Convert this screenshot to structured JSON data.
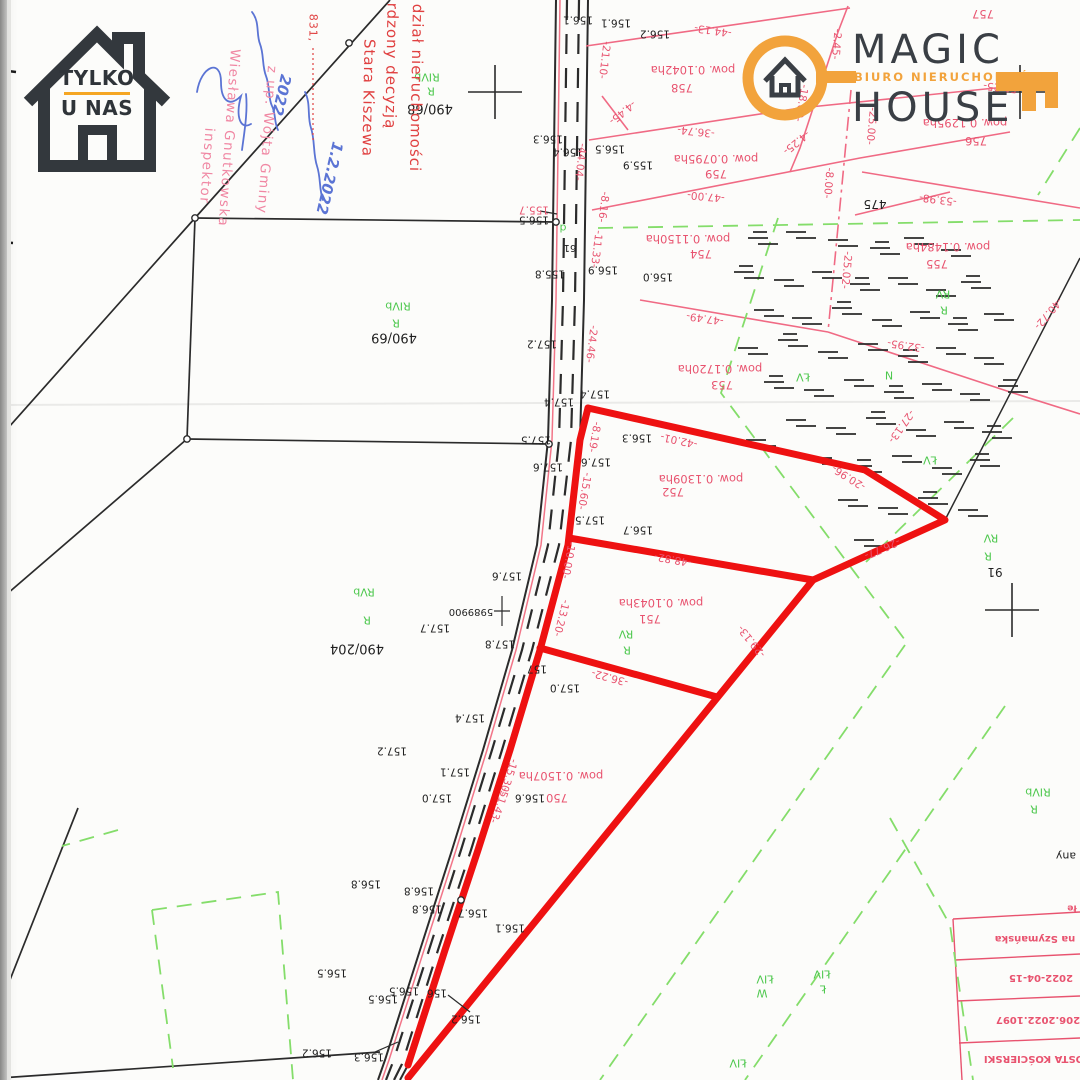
{
  "branding": {
    "tylko_u_nas": {
      "line1": "TYLKO",
      "line2": "U NAS",
      "accent_color": "#F5A623"
    },
    "magic_house": {
      "word1": "MAGIC",
      "word2": "HOUSE",
      "subtitle": "BIURO NIERUCHOMOŚCI",
      "accent_color": "#F2A33C",
      "text_color": "#3A3F45"
    }
  },
  "stamps": {
    "office": {
      "color": "#E04040",
      "lines": [
        {
          "t": "dział nieruchomości",
          "x": 416,
          "y": 88,
          "r": 91
        },
        {
          "t": "rdzony decyzją",
          "x": 391,
          "y": 66,
          "r": 91
        },
        {
          "t": "Stara Kiszewa",
          "x": 368,
          "y": 98,
          "r": 91
        },
        {
          "t": "831,",
          "x": 313,
          "y": 28,
          "r": 91,
          "s": 11
        }
      ]
    },
    "wojt": {
      "color": "#F087A3",
      "lines": [
        {
          "t": "z up. Wójta Gminy",
          "x": 266,
          "y": 140,
          "r": 94
        },
        {
          "t": "Wiesława Gnutkowska",
          "x": 228,
          "y": 138,
          "r": 94
        },
        {
          "t": "inspektor",
          "x": 206,
          "y": 166,
          "r": 94
        }
      ]
    },
    "handwriting": {
      "color": "#5B74D4",
      "lines": [
        {
          "t": "2022",
          "x": 281,
          "y": 95,
          "r": 103
        },
        {
          "t": "1.2.2022",
          "x": 329,
          "y": 178,
          "r": 103
        }
      ]
    }
  },
  "registry_table": {
    "color": "#E8536F",
    "rows": [
      {
        "t": "na Szymańska",
        "x": 1035,
        "y": 938
      },
      {
        "t": "2022-04-15",
        "x": 1041,
        "y": 977
      },
      {
        "t": "206.2022.1097",
        "x": 1038,
        "y": 1019
      },
      {
        "t": "OSTA KOŚCIERSKI",
        "x": 1034,
        "y": 1058
      }
    ],
    "notes": [
      {
        "t": "any",
        "x": 1066,
        "y": 856,
        "c": "b",
        "s": 11
      },
      {
        "t": "łe",
        "x": 1072,
        "y": 907,
        "c": "t",
        "s": 9
      }
    ]
  },
  "map": {
    "highlight_color": "#EE1111",
    "parcel_line_color": "#F06A84",
    "soil_line_color": "#84DD6A",
    "boundary_color": "#2B2B2B",
    "highlighted_parcel_numbers": [
      "750",
      "751",
      "752"
    ],
    "labels": [
      {
        "t": "156.1",
        "x": 578,
        "y": 19,
        "c": "b"
      },
      {
        "t": "156.1",
        "x": 616,
        "y": 22,
        "c": "b"
      },
      {
        "t": "156.2",
        "x": 655,
        "y": 33,
        "c": "b"
      },
      {
        "t": "156.3",
        "x": 548,
        "y": 138,
        "c": "b"
      },
      {
        "t": "156.4",
        "x": 568,
        "y": 151,
        "c": "b"
      },
      {
        "t": "156.5",
        "x": 610,
        "y": 148,
        "c": "b"
      },
      {
        "t": "155.9",
        "x": 638,
        "y": 164,
        "c": "b"
      },
      {
        "t": "156.5",
        "x": 534,
        "y": 219,
        "c": "b"
      },
      {
        "t": "155.7",
        "x": 534,
        "y": 209,
        "c": "m"
      },
      {
        "t": "155.8",
        "x": 550,
        "y": 273,
        "c": "b"
      },
      {
        "t": "156.9",
        "x": 603,
        "y": 269,
        "c": "b"
      },
      {
        "t": "156.0",
        "x": 658,
        "y": 276,
        "c": "b"
      },
      {
        "t": "157.2",
        "x": 542,
        "y": 343,
        "c": "b"
      },
      {
        "t": "157.4",
        "x": 595,
        "y": 393,
        "c": "b"
      },
      {
        "t": "157.4",
        "x": 559,
        "y": 401,
        "c": "b"
      },
      {
        "t": "157.5",
        "x": 536,
        "y": 439,
        "c": "b"
      },
      {
        "t": "157.6",
        "x": 548,
        "y": 466,
        "c": "b"
      },
      {
        "t": "157.6",
        "x": 596,
        "y": 461,
        "c": "b"
      },
      {
        "t": "157.5",
        "x": 590,
        "y": 519,
        "c": "b"
      },
      {
        "t": "156.7",
        "x": 638,
        "y": 529,
        "c": "b"
      },
      {
        "t": "156.3",
        "x": 637,
        "y": 437,
        "c": "b"
      },
      {
        "t": "157.6",
        "x": 507,
        "y": 575,
        "c": "b"
      },
      {
        "t": "157.7",
        "x": 435,
        "y": 627,
        "c": "b"
      },
      {
        "t": "157.8",
        "x": 500,
        "y": 643,
        "c": "b"
      },
      {
        "t": "157",
        "x": 537,
        "y": 668,
        "c": "b"
      },
      {
        "t": "157.0",
        "x": 565,
        "y": 687,
        "c": "b"
      },
      {
        "t": "157.4",
        "x": 470,
        "y": 717,
        "c": "b"
      },
      {
        "t": "157.2",
        "x": 392,
        "y": 750,
        "c": "b"
      },
      {
        "t": "157.1",
        "x": 455,
        "y": 771,
        "c": "b"
      },
      {
        "t": "157.0",
        "x": 437,
        "y": 797,
        "c": "b"
      },
      {
        "t": "156.6",
        "x": 530,
        "y": 797,
        "c": "b"
      },
      {
        "t": "156.8",
        "x": 366,
        "y": 883,
        "c": "b"
      },
      {
        "t": "156.8",
        "x": 419,
        "y": 890,
        "c": "b"
      },
      {
        "t": "156.8",
        "x": 427,
        "y": 908,
        "c": "b"
      },
      {
        "t": "156.7",
        "x": 473,
        "y": 912,
        "c": "b"
      },
      {
        "t": "156.1",
        "x": 510,
        "y": 927,
        "c": "b"
      },
      {
        "t": "156.5",
        "x": 332,
        "y": 972,
        "c": "b"
      },
      {
        "t": "156.5",
        "x": 404,
        "y": 990,
        "c": "b"
      },
      {
        "t": "156.5",
        "x": 383,
        "y": 998,
        "c": "b"
      },
      {
        "t": "156",
        "x": 437,
        "y": 992,
        "c": "b"
      },
      {
        "t": "156.2",
        "x": 466,
        "y": 1018,
        "c": "b"
      },
      {
        "t": "156.2",
        "x": 317,
        "y": 1052,
        "c": "b"
      },
      {
        "t": "156.3",
        "x": 369,
        "y": 1056,
        "c": "b"
      },
      {
        "t": "490/68",
        "x": 430,
        "y": 108,
        "c": "b",
        "s": 13
      },
      {
        "t": "490/69",
        "x": 394,
        "y": 337,
        "c": "b",
        "s": 13
      },
      {
        "t": "490/204",
        "x": 357,
        "y": 648,
        "c": "b",
        "s": 13
      },
      {
        "t": "91",
        "x": 995,
        "y": 572,
        "c": "b",
        "s": 12
      },
      {
        "t": "475",
        "x": 875,
        "y": 204,
        "c": "b",
        "s": 12
      },
      {
        "t": "5989900",
        "x": 471,
        "y": 611,
        "c": "b",
        "s": 10
      },
      {
        "t": "61",
        "x": 570,
        "y": 247,
        "c": "b",
        "s": 10
      },
      {
        "t": "-44.13-",
        "x": 713,
        "y": 30,
        "r": 188,
        "c": "m"
      },
      {
        "t": "-21.10-",
        "x": 604,
        "y": 60,
        "r": 97,
        "c": "m"
      },
      {
        "t": "-4.45-",
        "x": 622,
        "y": 112,
        "r": 140,
        "c": "m"
      },
      {
        "t": "-36.74-",
        "x": 696,
        "y": 131,
        "r": 186,
        "c": "m"
      },
      {
        "t": "-47.00-",
        "x": 706,
        "y": 196,
        "r": 185,
        "c": "m"
      },
      {
        "t": "-8.16-",
        "x": 603,
        "y": 207,
        "r": 97,
        "c": "m"
      },
      {
        "t": "-11.33-",
        "x": 596,
        "y": 249,
        "r": 97,
        "c": "m"
      },
      {
        "t": "-44.04-",
        "x": 580,
        "y": 162,
        "r": 97,
        "c": "m"
      },
      {
        "t": "-24.46-",
        "x": 591,
        "y": 344,
        "r": 97,
        "c": "m"
      },
      {
        "t": "-8.19-",
        "x": 594,
        "y": 437,
        "r": 100,
        "c": "m"
      },
      {
        "t": "-15.60-",
        "x": 584,
        "y": 491,
        "r": 100,
        "c": "m"
      },
      {
        "t": "-42.01-",
        "x": 679,
        "y": 440,
        "r": 192,
        "c": "m"
      },
      {
        "t": "-20.96-",
        "x": 849,
        "y": 477,
        "r": 212,
        "c": "m"
      },
      {
        "t": "-26.77-",
        "x": 882,
        "y": 548,
        "r": 156,
        "c": "m"
      },
      {
        "t": "-48.82-",
        "x": 673,
        "y": 559,
        "r": 190,
        "c": "m"
      },
      {
        "t": "-10.00-",
        "x": 568,
        "y": 560,
        "r": 100,
        "c": "m"
      },
      {
        "t": "-29.13-",
        "x": 752,
        "y": 641,
        "r": 231,
        "c": "m"
      },
      {
        "t": "-13.20-",
        "x": 561,
        "y": 618,
        "r": 104,
        "c": "m"
      },
      {
        "t": "-36.22-",
        "x": 610,
        "y": 677,
        "r": 195,
        "c": "m"
      },
      {
        "t": "-15.30-",
        "x": 508,
        "y": 777,
        "r": 108,
        "c": "m"
      },
      {
        "t": "-51.43-",
        "x": 499,
        "y": 805,
        "r": 110,
        "c": "m"
      },
      {
        "t": "-47.49-",
        "x": 705,
        "y": 318,
        "r": 188,
        "c": "m"
      },
      {
        "t": "-25.02-",
        "x": 846,
        "y": 270,
        "r": 95,
        "c": "m"
      },
      {
        "t": "-32.95-",
        "x": 906,
        "y": 345,
        "r": 188,
        "c": "m"
      },
      {
        "t": "-53.98-",
        "x": 938,
        "y": 199,
        "r": 187,
        "c": "m"
      },
      {
        "t": "-40.72-",
        "x": 1048,
        "y": 313,
        "r": 130,
        "c": "m"
      },
      {
        "t": "-27.13-",
        "x": 901,
        "y": 426,
        "r": 125,
        "c": "m"
      },
      {
        "t": "-2.45-",
        "x": 836,
        "y": 44,
        "r": 95,
        "c": "m"
      },
      {
        "t": "-18.69-",
        "x": 801,
        "y": 103,
        "r": 100,
        "c": "m"
      },
      {
        "t": "-4.25-",
        "x": 796,
        "y": 142,
        "r": 140,
        "c": "m"
      },
      {
        "t": "-25.00-",
        "x": 871,
        "y": 126,
        "r": 95,
        "c": "m"
      },
      {
        "t": "-51.25-",
        "x": 1002,
        "y": 87,
        "r": 186,
        "c": "m"
      },
      {
        "t": "-8.00-",
        "x": 828,
        "y": 183,
        "r": 95,
        "c": "m"
      },
      {
        "t": "pow. 0.1042ha",
        "x": 693,
        "y": 69,
        "c": "p"
      },
      {
        "t": "758",
        "x": 682,
        "y": 87,
        "c": "p"
      },
      {
        "t": "pow. 0.0795ha",
        "x": 716,
        "y": 158,
        "c": "p"
      },
      {
        "t": "759",
        "x": 716,
        "y": 173,
        "c": "p"
      },
      {
        "t": "pow. 0.1150ha",
        "x": 688,
        "y": 238,
        "c": "p"
      },
      {
        "t": "754",
        "x": 701,
        "y": 253,
        "c": "p"
      },
      {
        "t": "pow. 0.1720ha",
        "x": 720,
        "y": 368,
        "c": "p"
      },
      {
        "t": "753",
        "x": 722,
        "y": 384,
        "c": "p"
      },
      {
        "t": "pow. 0.1484ha",
        "x": 948,
        "y": 246,
        "c": "p"
      },
      {
        "t": "755",
        "x": 937,
        "y": 263,
        "c": "p"
      },
      {
        "t": "pow. 0.1295ha",
        "x": 965,
        "y": 122,
        "c": "p"
      },
      {
        "t": "756",
        "x": 976,
        "y": 140,
        "c": "p"
      },
      {
        "t": "757",
        "x": 983,
        "y": 13,
        "c": "p"
      },
      {
        "t": "pow. 0.1309ha",
        "x": 701,
        "y": 478,
        "c": "p"
      },
      {
        "t": "752",
        "x": 673,
        "y": 491,
        "c": "p"
      },
      {
        "t": "pow. 0.1043ha",
        "x": 661,
        "y": 602,
        "c": "p"
      },
      {
        "t": "751",
        "x": 650,
        "y": 618,
        "c": "p"
      },
      {
        "t": "pow. 0.1507ha",
        "x": 561,
        "y": 775,
        "c": "p"
      },
      {
        "t": "750",
        "x": 557,
        "y": 797,
        "c": "p"
      },
      {
        "t": "RIVb",
        "x": 427,
        "y": 77,
        "c": "g"
      },
      {
        "t": "R",
        "x": 431,
        "y": 91,
        "c": "g"
      },
      {
        "t": "RIVb",
        "x": 398,
        "y": 306,
        "c": "g"
      },
      {
        "t": "R",
        "x": 396,
        "y": 323,
        "c": "g"
      },
      {
        "t": "RVb",
        "x": 364,
        "y": 592,
        "c": "g"
      },
      {
        "t": "R",
        "x": 367,
        "y": 620,
        "c": "g"
      },
      {
        "t": "RV",
        "x": 626,
        "y": 634,
        "c": "g"
      },
      {
        "t": "R",
        "x": 627,
        "y": 650,
        "c": "g"
      },
      {
        "t": "RV",
        "x": 943,
        "y": 294,
        "c": "g"
      },
      {
        "t": "R",
        "x": 944,
        "y": 310,
        "c": "g"
      },
      {
        "t": "RV",
        "x": 991,
        "y": 538,
        "c": "g"
      },
      {
        "t": "R",
        "x": 988,
        "y": 556,
        "c": "g"
      },
      {
        "t": "ŁV",
        "x": 803,
        "y": 377,
        "c": "g"
      },
      {
        "t": "ŁV",
        "x": 930,
        "y": 460,
        "c": "g"
      },
      {
        "t": "N",
        "x": 889,
        "y": 375,
        "c": "g"
      },
      {
        "t": "ŁIV",
        "x": 765,
        "y": 979,
        "c": "g"
      },
      {
        "t": "W",
        "x": 762,
        "y": 993,
        "c": "g"
      },
      {
        "t": "ŁIV",
        "x": 822,
        "y": 974,
        "c": "g"
      },
      {
        "t": "Ł",
        "x": 823,
        "y": 989,
        "c": "g"
      },
      {
        "t": "ŁIV",
        "x": 738,
        "y": 1063,
        "c": "g"
      },
      {
        "t": "RIVb",
        "x": 1038,
        "y": 792,
        "c": "g"
      },
      {
        "t": "R",
        "x": 1034,
        "y": 809,
        "c": "g"
      },
      {
        "t": "d",
        "x": 563,
        "y": 228,
        "c": "g"
      }
    ]
  }
}
